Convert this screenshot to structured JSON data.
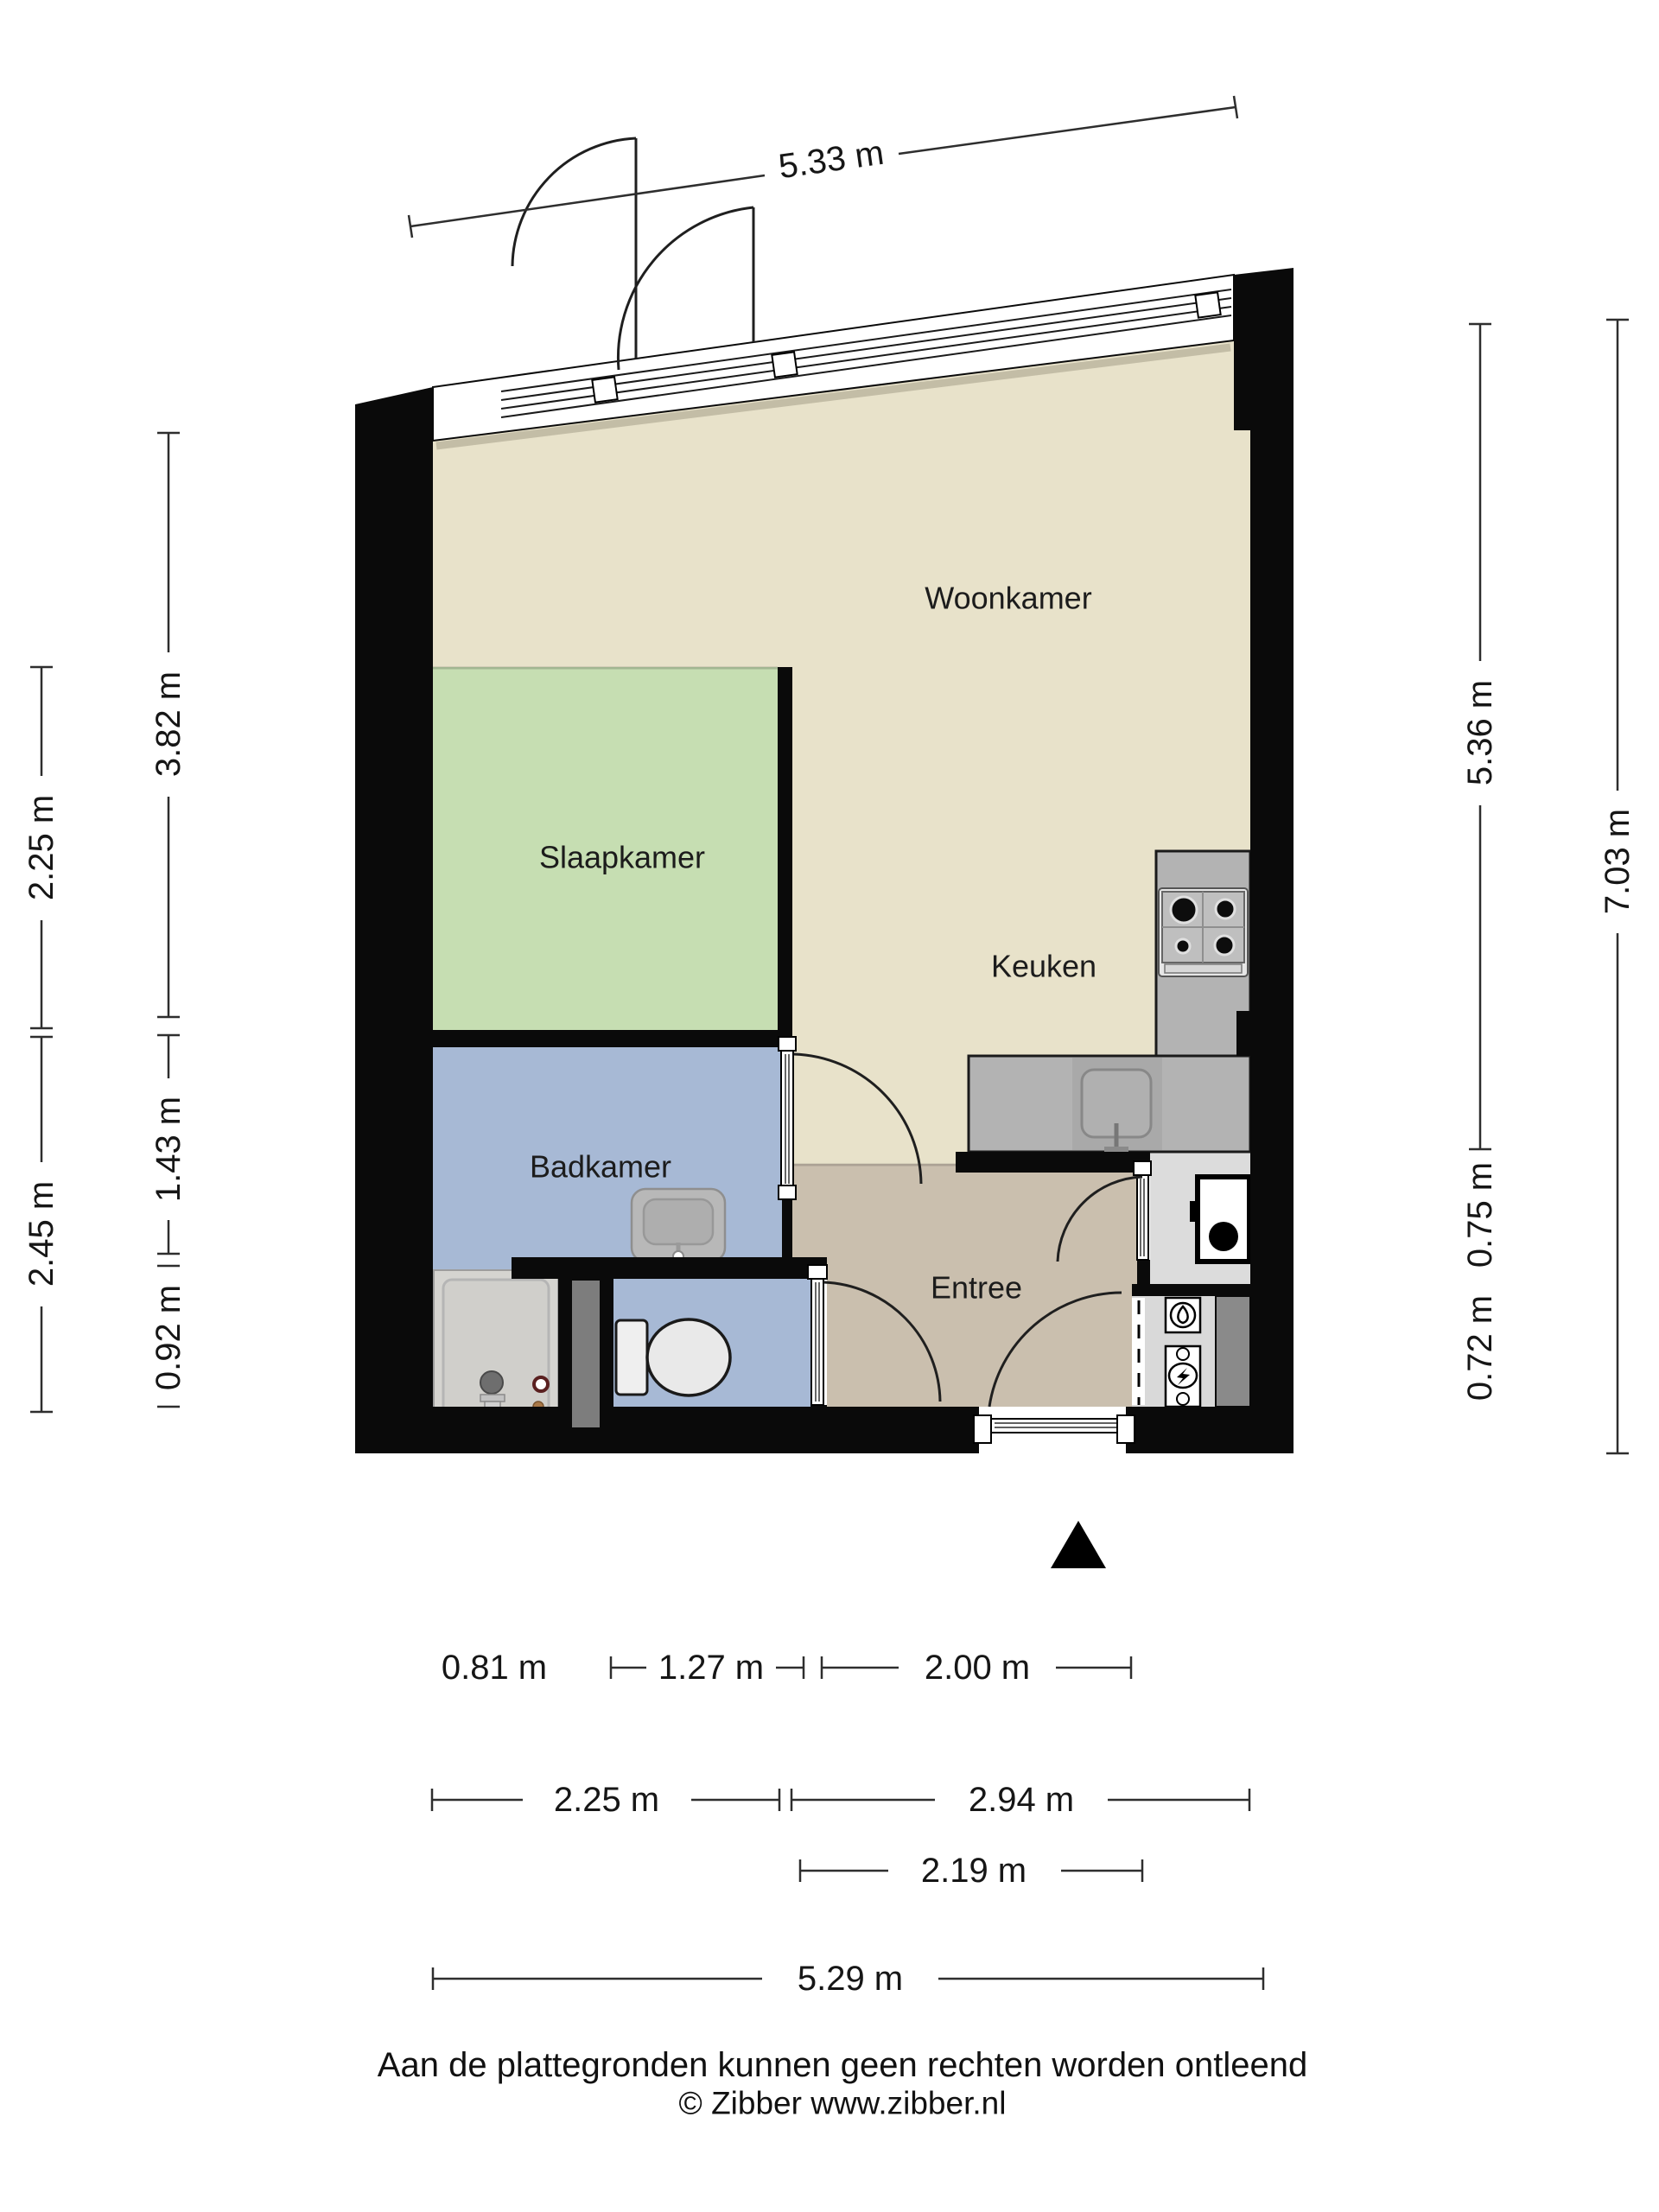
{
  "rooms": [
    {
      "name": "woonkamer",
      "label": "Woonkamer"
    },
    {
      "name": "slaapkamer",
      "label": "Slaapkamer"
    },
    {
      "name": "keuken",
      "label": "Keuken"
    },
    {
      "name": "badkamer",
      "label": "Badkamer"
    },
    {
      "name": "entree",
      "label": "Entree"
    }
  ],
  "dimensions": {
    "top": "5.33 m",
    "left_outer_upper": "2.25 m",
    "left_outer_lower": "2.45 m",
    "left_inner_upper": "3.82 m",
    "left_inner_middle": "1.43 m",
    "left_inner_lower": "0.92 m",
    "right_inner_upper": "5.36 m",
    "right_inner_middle": "0.75 m",
    "right_inner_lower": "0.72 m",
    "right_outer": "7.03 m",
    "bottom_row1_shower": "0.81 m",
    "bottom_row1_toilet": "1.27 m",
    "bottom_row1_entree": "2.00 m",
    "bottom_row2_badkamer": "2.25 m",
    "bottom_row2_woonkamer": "2.94 m",
    "bottom_row3": "2.19 m",
    "bottom_row4": "5.29 m"
  },
  "footer": {
    "disclaimer": "Aan de plattegronden kunnen geen rechten worden ontleend",
    "copyright": "© Zibber www.zibber.nl"
  },
  "colors": {
    "woonkamer": "#e8e2ca",
    "slaapkamer": "#c6deb2",
    "badkamer": "#a7b9d5",
    "toilet": "#a7b9d5",
    "entree": "#cabfae",
    "closet": "#dcdcdc",
    "meterkast": "#d9d9d9",
    "counter": "#b3b3b3",
    "wall": "#0a0a0a"
  }
}
